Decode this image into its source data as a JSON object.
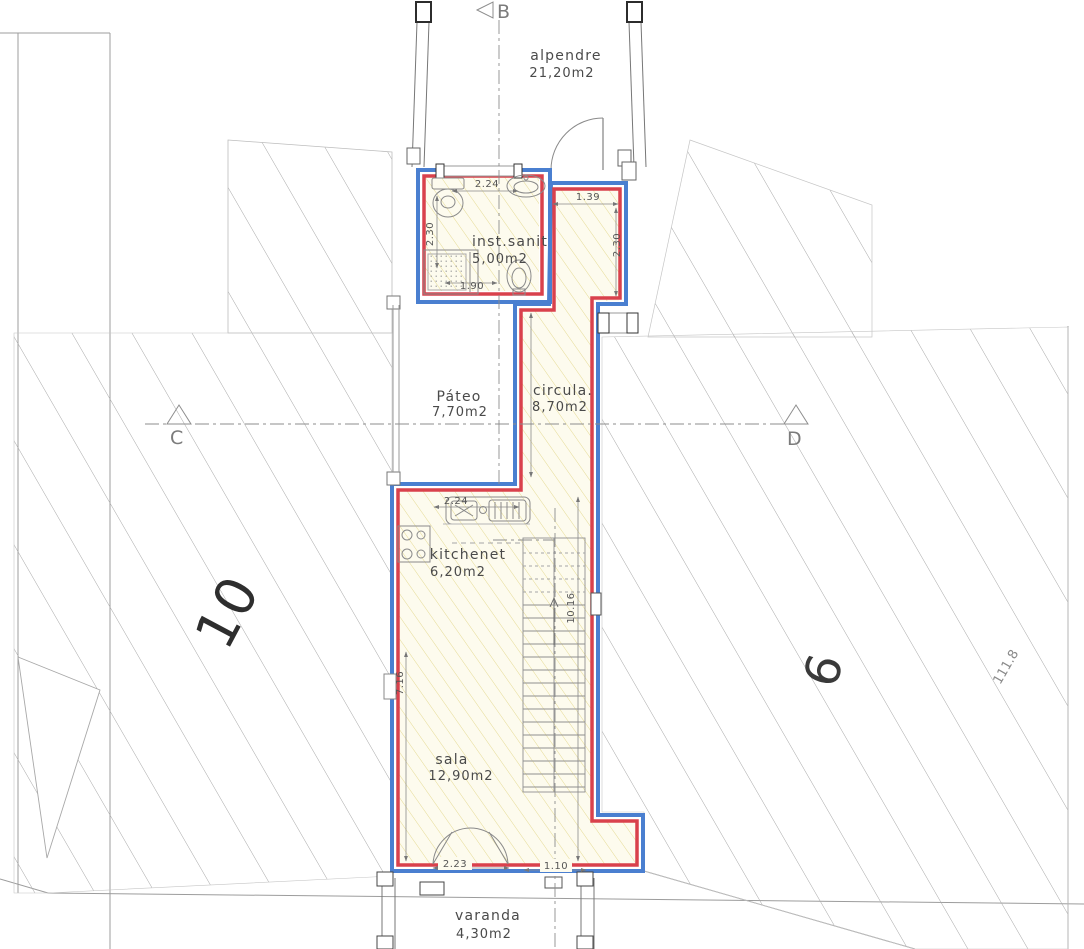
{
  "plan": {
    "rooms": {
      "alpendre": {
        "name": "alpendre",
        "area": "21,20m2"
      },
      "inst_sanit": {
        "name": "inst.sanit",
        "area": "5,00m2"
      },
      "pateo": {
        "name": "Páteo",
        "area": "7,70m2"
      },
      "circula": {
        "name": "circula.",
        "area": "8,70m2"
      },
      "kitchenet": {
        "name": "kitchenet",
        "area": "6,20m2"
      },
      "sala": {
        "name": "sala",
        "area": "12,90m2"
      },
      "varanda": {
        "name": "varanda",
        "area": "4,30m2"
      }
    },
    "dimensions": {
      "bath_width": "2.24",
      "bath_depth": "2.30",
      "shower_width": "1.90",
      "hall_width": "1.39",
      "hall_depth": "2.30",
      "kitchen_width": "2.24",
      "interior_length": "10.16",
      "sala_length": "7.16",
      "door_double": "2.23",
      "door_single": "1.10"
    },
    "lots": {
      "left_number": "10",
      "right_number": "6",
      "boundary_length": "111.8"
    },
    "sections": {
      "b": "B",
      "c": "C",
      "d": "D"
    },
    "colors": {
      "wall_inner": "#d9414c",
      "wall_outer": "#4a7fd0",
      "room_hatch": "#e5da94",
      "lot_hatch": "#a8a8a8"
    }
  }
}
